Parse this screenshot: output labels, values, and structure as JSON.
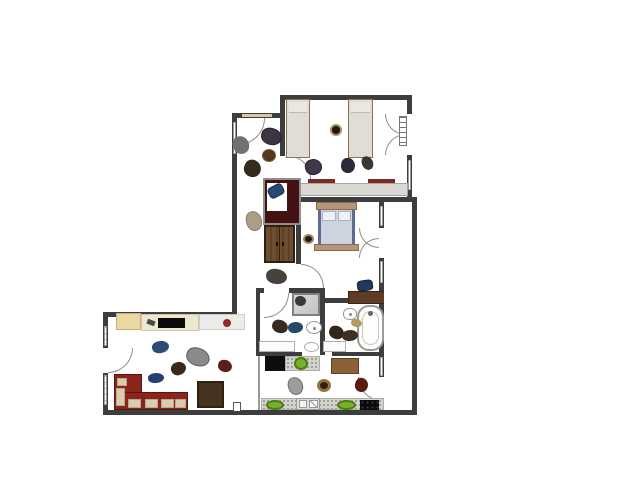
{
  "scene": {
    "type": "apartment-floor-plan",
    "background": "#ffffff",
    "wall_color": "#3d3d3d"
  },
  "palette": {
    "walls": "#3d3d3d",
    "sofa_red": "#8c241e",
    "cushion_beige": "#d8cdb2",
    "maroon_desk": "#451114",
    "wood_wardrobe": "#6e4e30",
    "wood_desk": "#5e3c24",
    "bed_frame_tan": "#b2977a",
    "bed_linen_blue": "#cdd4e0",
    "mattress_beige": "#e0ddd4",
    "plant_green": "#79b02c",
    "counter_speckle_gray": "#d4d4ce",
    "stove_black": "#0d0d0d",
    "fixture_white": "#fdfdfd",
    "accent_red_dot": "#8f2b24"
  },
  "rooms": [
    {
      "name": "bedroom-twin",
      "furniture": [
        "single-bed",
        "single-bed",
        "built-in-closet-double-door",
        "radiator",
        "long-desk",
        "chair-mark",
        "chair-mark",
        "toy",
        "clothes-pile",
        "clothes-pile",
        "clothes-pile"
      ]
    },
    {
      "name": "bedroom-double",
      "furniture": [
        "double-bed",
        "closet-double-door",
        "desk",
        "desk-chair",
        "shoe-pair"
      ]
    },
    {
      "name": "hallway",
      "furniture": [
        "maroon-desk",
        "desk-chair",
        "wardrobe",
        "clothes-pile",
        "clothes-pile",
        "clothes-pile",
        "clothes-pile",
        "clothes-pile",
        "clothes-pile"
      ]
    },
    {
      "name": "bathroom-shower",
      "furniture": [
        "shower-stall",
        "toilet",
        "washbasin-counter",
        "basin",
        "clothes-pile",
        "clothes-pile"
      ]
    },
    {
      "name": "bathroom-tub",
      "furniture": [
        "bathtub",
        "toilet",
        "washbasin-counter",
        "clothes-pile",
        "clothes-pile",
        "clothes-pile"
      ]
    },
    {
      "name": "kitchen",
      "furniture": [
        "stove",
        "counter",
        "sink",
        "cooktop",
        "plant",
        "plant",
        "plant",
        "rug",
        "clothes-pile",
        "hat",
        "clothes-pile"
      ]
    },
    {
      "name": "living-room",
      "furniture": [
        "sideboard",
        "tv",
        "red-dot-decor",
        "corner-sofa",
        "coffee-table",
        "clothes-pile",
        "clothes-pile",
        "clothes-pile",
        "clothes-pile",
        "clothes-pile"
      ]
    },
    {
      "name": "balcony",
      "furniture": []
    }
  ]
}
